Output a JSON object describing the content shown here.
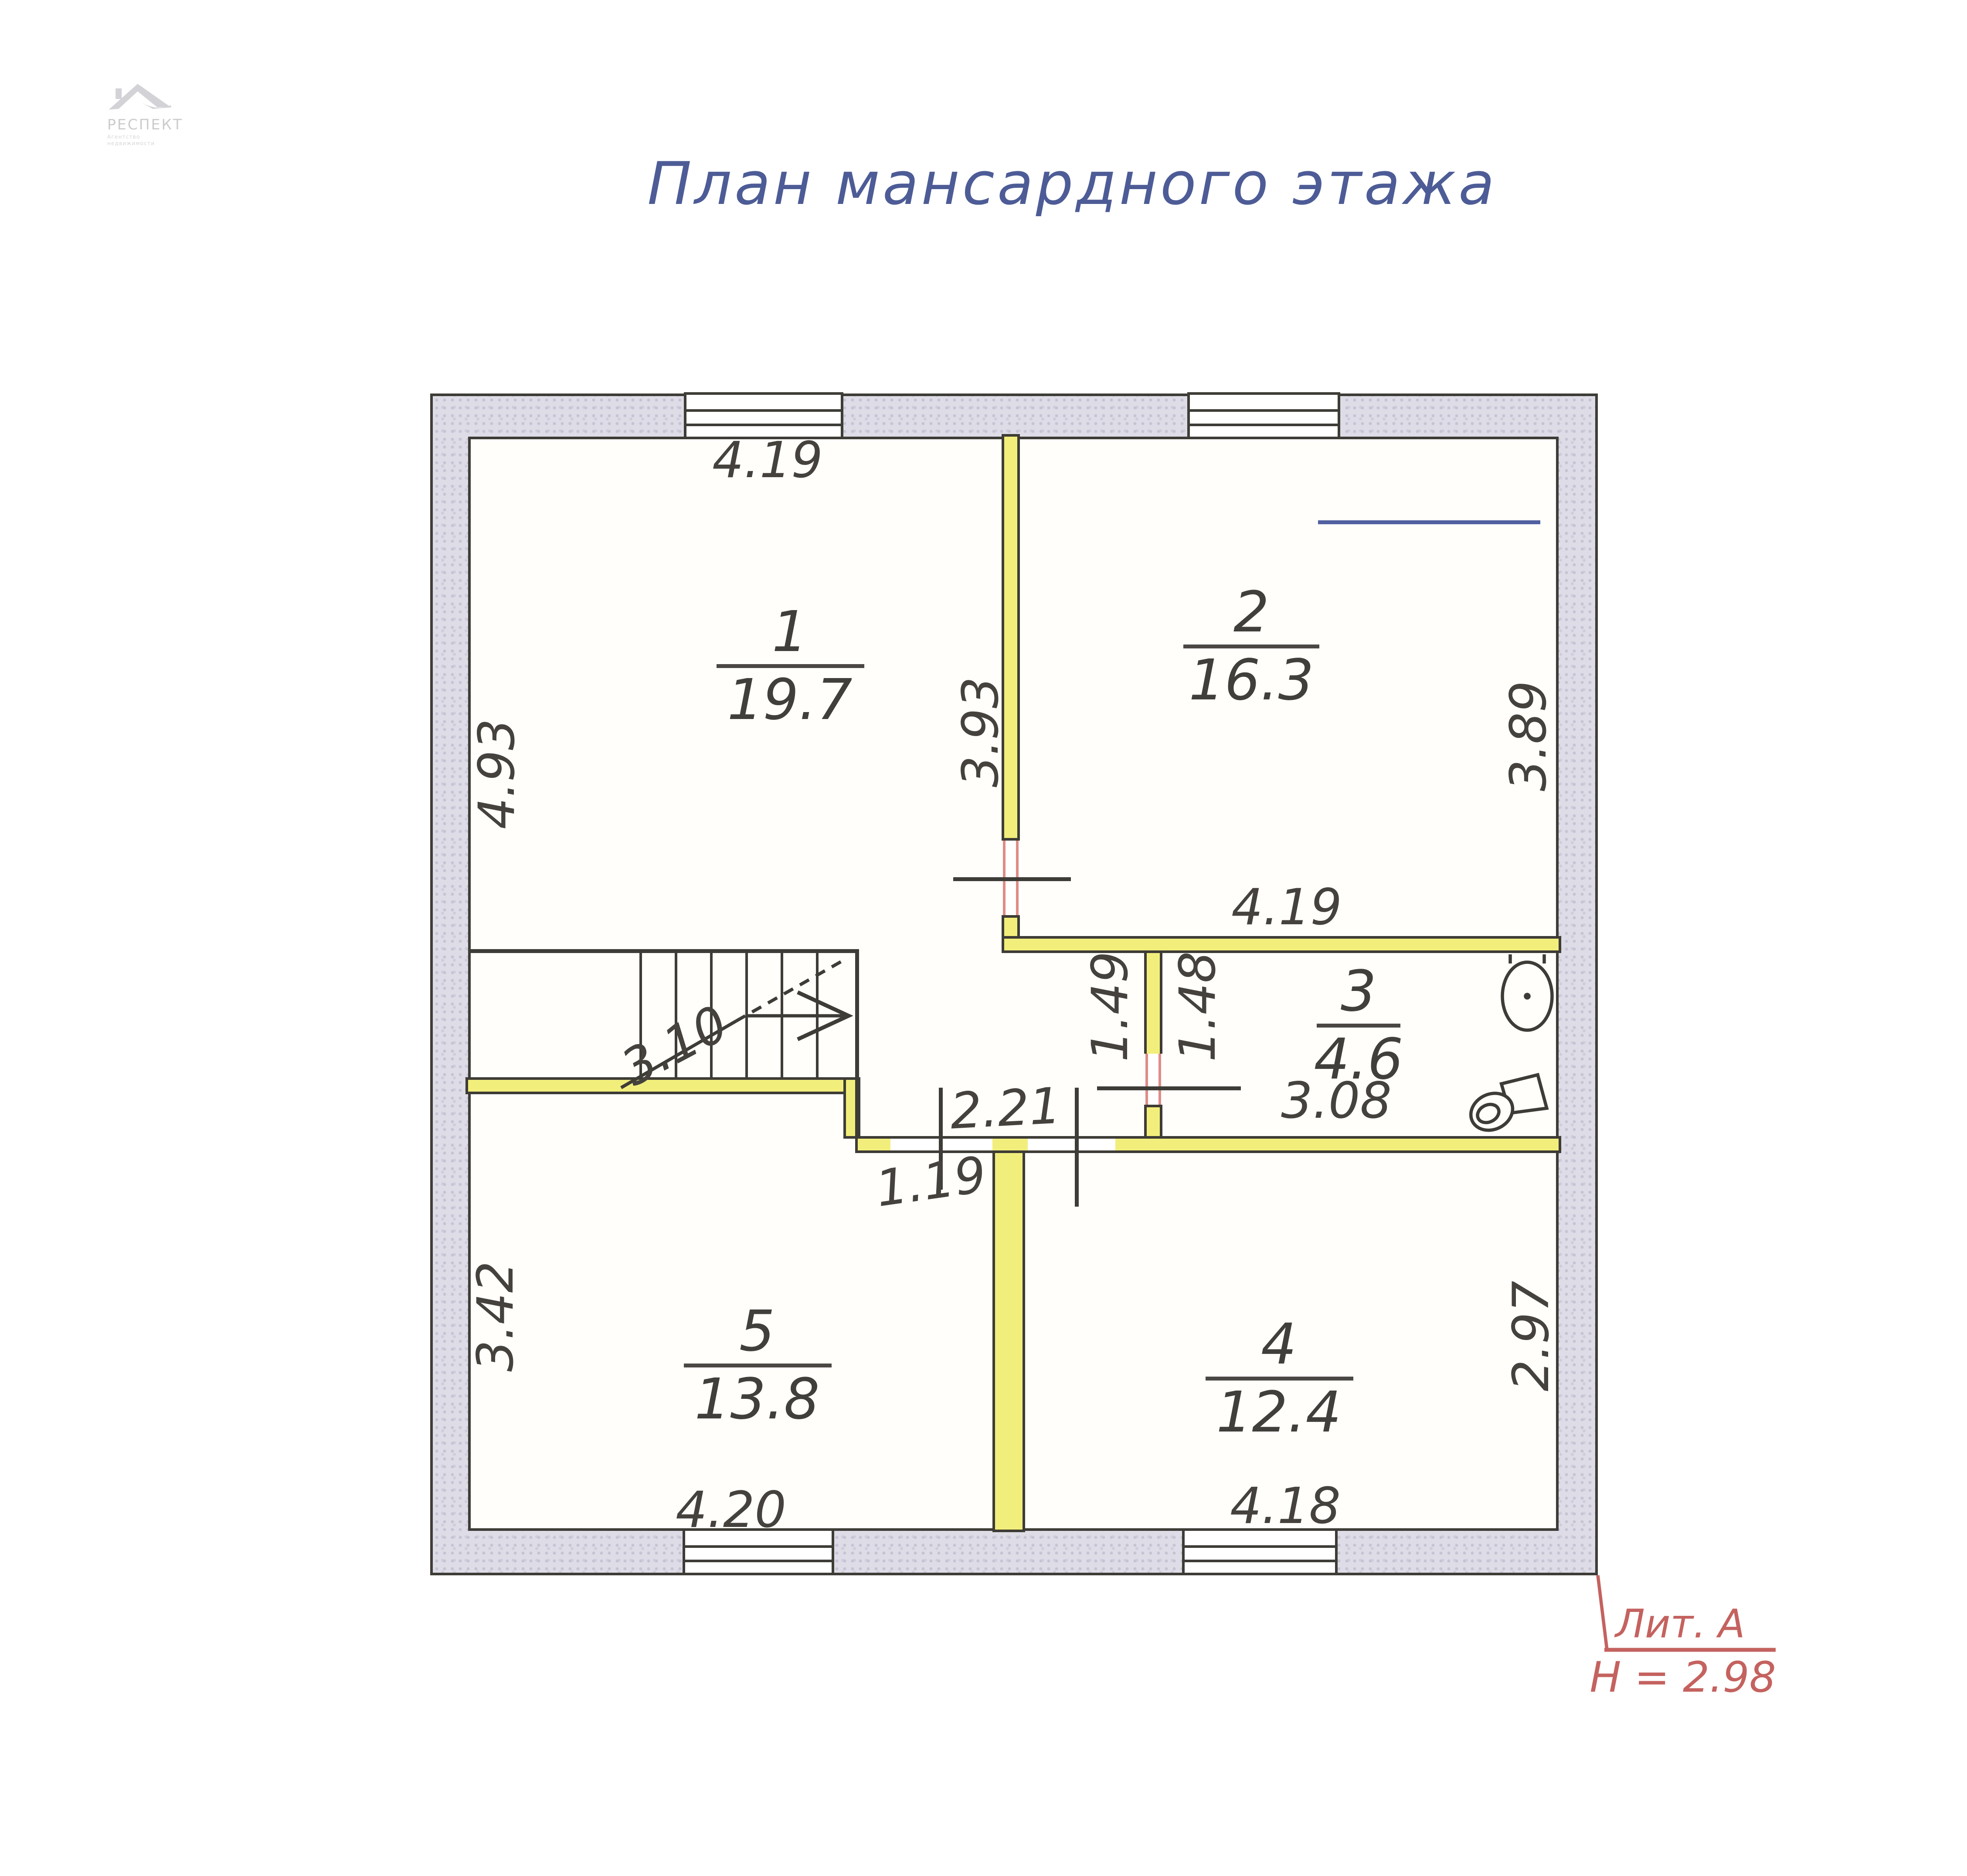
{
  "title": "План мансардного этажа",
  "logo": {
    "name": "РЕСПЕКТ",
    "tagline": "Агентство недвижимости"
  },
  "notes": {
    "ceiling_full": "h = 2.68",
    "ceiling_low": "h = 1.48"
  },
  "liter": {
    "label": "Лит. А",
    "height": "Н = 2.98"
  },
  "rooms": [
    {
      "number": "1",
      "area": "19.7"
    },
    {
      "number": "2",
      "area": "16.3"
    },
    {
      "number": "3",
      "area": "4.6"
    },
    {
      "number": "4",
      "area": "12.4"
    },
    {
      "number": "5",
      "area": "13.8"
    }
  ],
  "dims": {
    "room1_width": "4.19",
    "room1_height": "4.93",
    "room1_inner": "3.93",
    "room2_inner": "3.89",
    "room2_width": "4.19",
    "hall_depth": "1.49",
    "bath_depth": "1.48",
    "bath_width": "3.08",
    "stair_run": "3.10",
    "hall_width": "2.21",
    "passage_width": "1.19",
    "room5_height": "3.42",
    "room5_width": "4.20",
    "room4_width": "4.18",
    "room4_height": "2.97"
  },
  "colors": {
    "title_blue": "#4d5c96",
    "note_blue": "#5160a0",
    "dimension_gray": "#45423e",
    "wall_fill": "#dedce6",
    "wall_line": "#3e3c36",
    "partition_yellow": "#f2ee7b",
    "annotation_red": "#c4625f",
    "logo_gray": "#cfcfd3"
  }
}
